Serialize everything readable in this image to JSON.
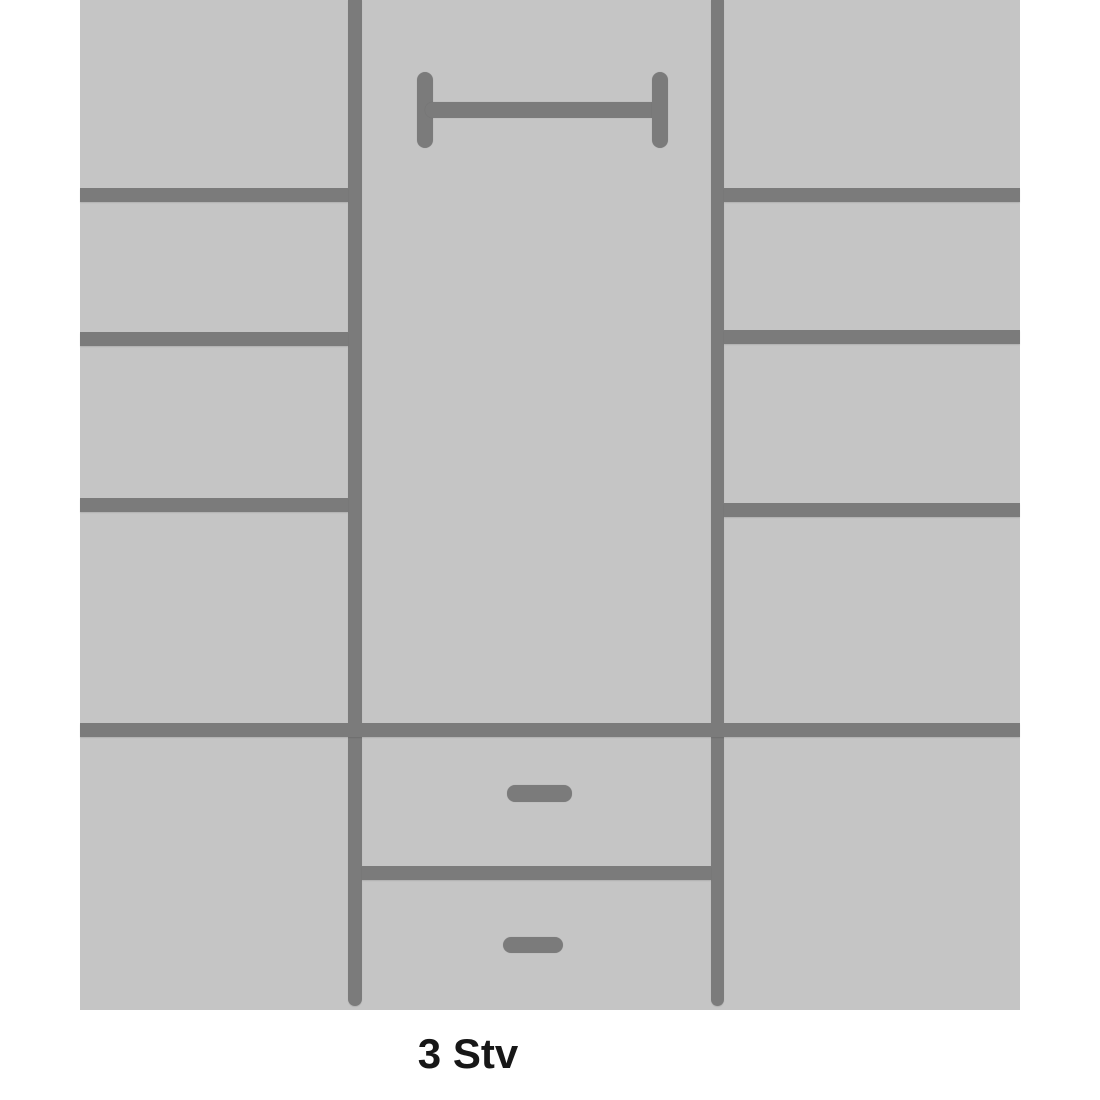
{
  "caption": {
    "text": "3 Stv"
  },
  "colors": {
    "page_bg": "#ffffff",
    "panel": "#c5c5c5",
    "line": "#7b7b7b",
    "caption_text": "#171717"
  },
  "diagram": {
    "description": "Wardrobe interior layout schematic: left column with four shelf compartments, middle column with a clothes rail above an open hanging space and two drawers with handles, right column with four shelf compartments",
    "stage": {
      "width": 1100,
      "height": 1100
    },
    "elements": [
      {
        "name": "wardrobe-body",
        "kind": "panel",
        "x": 80,
        "y": 0,
        "w": 940,
        "h": 1010,
        "color": "panel",
        "radius": "0"
      },
      {
        "name": "left-vertical-divider",
        "kind": "line",
        "x": 348,
        "y": 0,
        "w": 14,
        "h": 1006,
        "color": "line",
        "radius": "0 0 7px 7px"
      },
      {
        "name": "right-vertical-divider",
        "kind": "line",
        "x": 711,
        "y": 0,
        "w": 13,
        "h": 1006,
        "color": "line",
        "radius": "0 0 7px 7px"
      },
      {
        "name": "left-shelf-line-1",
        "kind": "line",
        "x": 80,
        "y": 188,
        "w": 268,
        "h": 14,
        "color": "line",
        "radius": "0"
      },
      {
        "name": "left-shelf-line-2",
        "kind": "line",
        "x": 80,
        "y": 332,
        "w": 268,
        "h": 14,
        "color": "line",
        "radius": "0"
      },
      {
        "name": "left-shelf-line-3",
        "kind": "line",
        "x": 80,
        "y": 498,
        "w": 268,
        "h": 14,
        "color": "line",
        "radius": "0"
      },
      {
        "name": "right-shelf-line-1",
        "kind": "line",
        "x": 724,
        "y": 188,
        "w": 296,
        "h": 14,
        "color": "line",
        "radius": "0"
      },
      {
        "name": "right-shelf-line-2",
        "kind": "line",
        "x": 724,
        "y": 330,
        "w": 296,
        "h": 14,
        "color": "line",
        "radius": "0"
      },
      {
        "name": "right-shelf-line-3",
        "kind": "line",
        "x": 724,
        "y": 503,
        "w": 296,
        "h": 14,
        "color": "line",
        "radius": "0"
      },
      {
        "name": "bottom-section-top-line",
        "kind": "line",
        "x": 80,
        "y": 723,
        "w": 940,
        "h": 14,
        "color": "line",
        "radius": "0"
      },
      {
        "name": "drawer-divider-line",
        "kind": "line",
        "x": 362,
        "y": 866,
        "w": 349,
        "h": 14,
        "color": "line",
        "radius": "0"
      },
      {
        "name": "clothes-rail-left-cap-icon",
        "kind": "icon-part",
        "x": 417,
        "y": 72,
        "w": 16,
        "h": 76,
        "color": "line",
        "radius": "8px"
      },
      {
        "name": "clothes-rail-bar-icon",
        "kind": "icon-part",
        "x": 425,
        "y": 102,
        "w": 235,
        "h": 16,
        "color": "line",
        "radius": "8px"
      },
      {
        "name": "clothes-rail-right-cap-icon",
        "kind": "icon-part",
        "x": 652,
        "y": 72,
        "w": 16,
        "h": 76,
        "color": "line",
        "radius": "8px"
      },
      {
        "name": "drawer-handle-1-icon",
        "kind": "icon-part",
        "x": 507,
        "y": 785,
        "w": 65,
        "h": 17,
        "color": "line",
        "radius": "8px"
      },
      {
        "name": "drawer-handle-2-icon",
        "kind": "icon-part",
        "x": 503,
        "y": 937,
        "w": 60,
        "h": 16,
        "color": "line",
        "radius": "8px"
      }
    ]
  }
}
